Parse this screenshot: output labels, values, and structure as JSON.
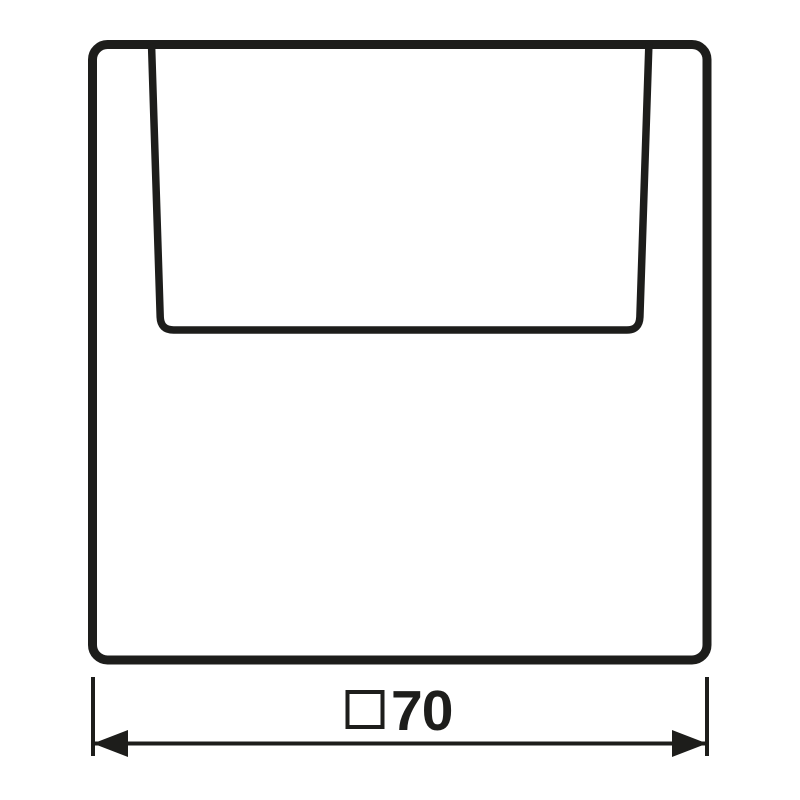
{
  "page": {
    "background_color": "#ffffff"
  },
  "drawing": {
    "type": "technical-dimension-drawing",
    "line_color": "#1d1d1b",
    "shapes": {
      "plate": "rounded-square-cover-plate-outline",
      "card_slot": "trapezoid-card-slot-outline"
    },
    "dimension": {
      "label": "□70",
      "symbol": "□",
      "value": "70"
    }
  }
}
